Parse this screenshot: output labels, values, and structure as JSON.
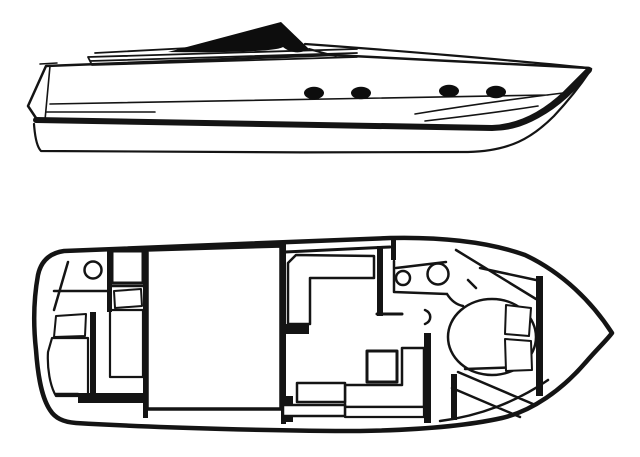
{
  "canvas": {
    "width": 640,
    "height": 457,
    "background": "#ffffff"
  },
  "colors": {
    "paper": "#ffffff",
    "ink": "#141414",
    "hull_gray": "#8a8a8a",
    "accent_black": "#0d0d0d"
  },
  "views": {
    "profile": {
      "name": "side-profile-view",
      "porthole_count": 4,
      "features": [
        "windshield",
        "deck-step-lines",
        "hull-side",
        "boot-stripe",
        "underbody"
      ]
    },
    "plan": {
      "name": "deck-plan-view",
      "features": [
        "aft-head-toilet",
        "aft-twin-berths",
        "cockpit-hatch",
        "l-shaped-settee",
        "galley-sinks",
        "dinette-table",
        "lower-l-bench",
        "v-berth-double-bed",
        "bow-bulkhead"
      ],
      "sink_count": 2,
      "berth_count": 3
    }
  }
}
